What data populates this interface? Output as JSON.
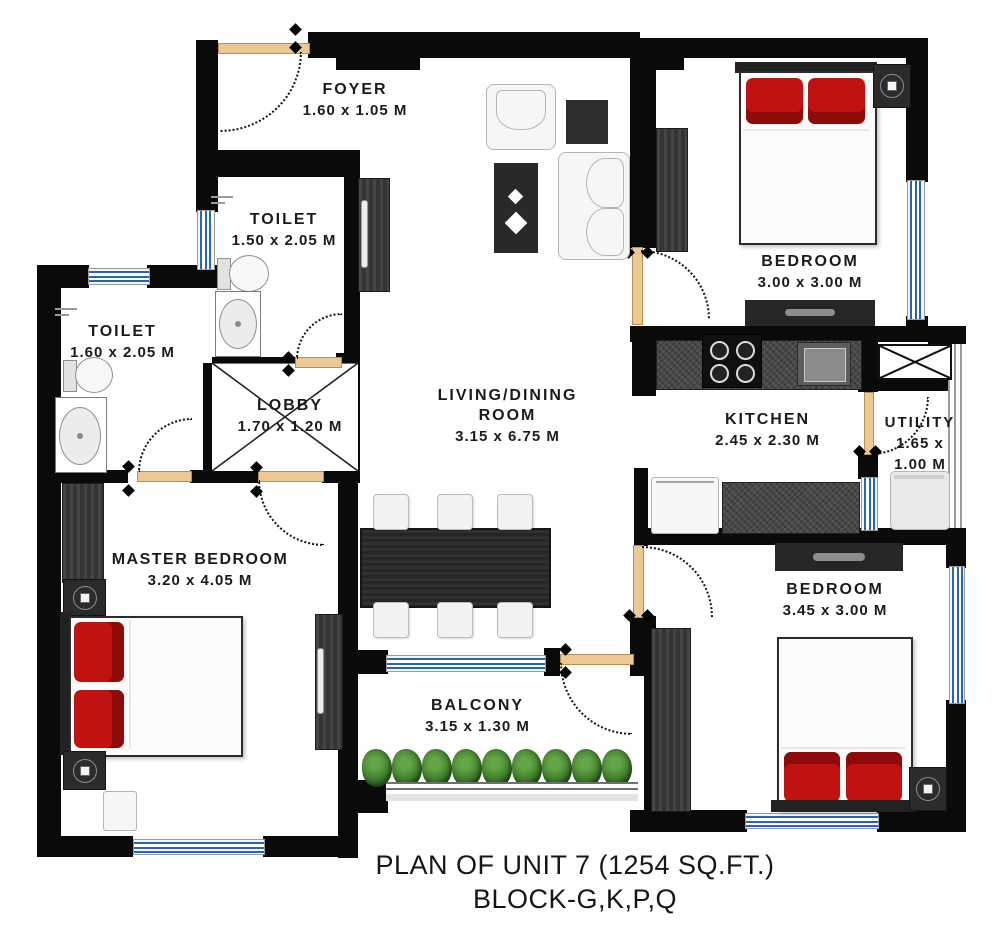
{
  "title": {
    "line1": "PLAN OF UNIT 7 (1254 SQ.FT.)",
    "line2": "BLOCK-G,K,P,Q"
  },
  "rooms": {
    "foyer": {
      "name": "FOYER",
      "dims": "1.60 x 1.05 M"
    },
    "toilet_top": {
      "name": "TOILET",
      "dims": "1.50 x 2.05 M"
    },
    "toilet_left": {
      "name": "TOILET",
      "dims": "1.60 x 2.05 M"
    },
    "lobby": {
      "name": "LOBBY",
      "dims": "1.70 x 1.20 M"
    },
    "living_dining": {
      "name_line1": "LIVING/DINING",
      "name_line2": "ROOM",
      "dims": "3.15 x 6.75 M"
    },
    "bedroom_top_right": {
      "name": "BEDROOM",
      "dims": "3.00 x 3.00 M"
    },
    "kitchen": {
      "name": "KITCHEN",
      "dims": "2.45 x 2.30 M"
    },
    "utility": {
      "name": "UTILITY",
      "dims_line1": "1.65 x",
      "dims_line2": "1.00 M"
    },
    "master_bedroom": {
      "name": "MASTER BEDROOM",
      "dims": "3.20 x 4.05 M"
    },
    "bedroom_bottom_right": {
      "name": "BEDROOM",
      "dims": "3.45 x 3.00 M"
    },
    "balcony": {
      "name": "BALCONY",
      "dims": "3.15 x 1.30 M"
    }
  },
  "colors": {
    "wall": "#0a0a0a",
    "window": "#2766ae",
    "door": "#ecc894",
    "pillow": "#c11212",
    "plant": "#3e7b2b",
    "dark": "#2e2e2e",
    "label": "#1b1b1b"
  }
}
